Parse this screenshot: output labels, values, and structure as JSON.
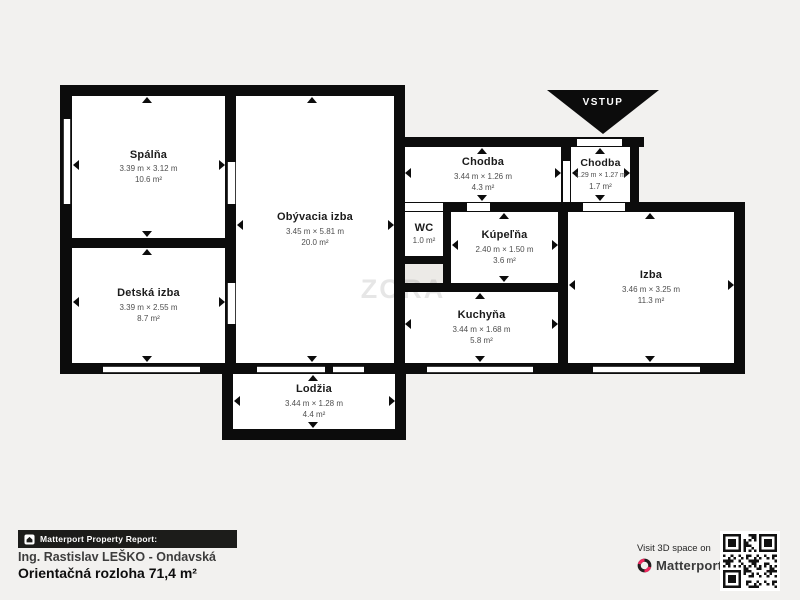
{
  "plan": {
    "watermark": "ZORA",
    "entrance_label": "VSTUP",
    "rooms": [
      {
        "id": "spalna",
        "name": "Spálňa",
        "dims": "3.39 m × 3.12 m",
        "area": "10.6 m²"
      },
      {
        "id": "detska",
        "name": "Detská izba",
        "dims": "3.39 m × 2.55 m",
        "area": "8.7 m²"
      },
      {
        "id": "obyvacia",
        "name": "Obývacia izba",
        "dims": "3.45 m × 5.81 m",
        "area": "20.0 m²"
      },
      {
        "id": "lodzia",
        "name": "Lodžia",
        "dims": "3.44 m × 1.28 m",
        "area": "4.4 m²"
      },
      {
        "id": "chodba1",
        "name": "Chodba",
        "dims": "3.44 m × 1.26 m",
        "area": "4.3 m²"
      },
      {
        "id": "chodba2",
        "name": "Chodba",
        "dims": "1.29 m × 1.27 m",
        "area": "1.7 m²"
      },
      {
        "id": "wc",
        "name": "WC",
        "dims": "",
        "area": "1.0 m²"
      },
      {
        "id": "kupelna",
        "name": "Kúpeľňa",
        "dims": "2.40 m × 1.50 m",
        "area": "3.6 m²"
      },
      {
        "id": "kuchyna",
        "name": "Kuchyňa",
        "dims": "3.44 m × 1.68 m",
        "area": "5.8 m²"
      },
      {
        "id": "izba",
        "name": "Izba",
        "dims": "3.46 m × 3.25 m",
        "area": "11.3 m²"
      }
    ]
  },
  "footer": {
    "report_badge": "Matterport Property Report:",
    "agent": "Ing. Rastislav LEŠKO - Ondavská",
    "area_total": "Orientačná rozloha 71,4 m²",
    "visit_text": "Visit 3D space on",
    "brand": "Matterport"
  },
  "colors": {
    "background": "#f2f1ef",
    "wall": "#0c0c0c",
    "accent_pink": "#f2275e"
  }
}
